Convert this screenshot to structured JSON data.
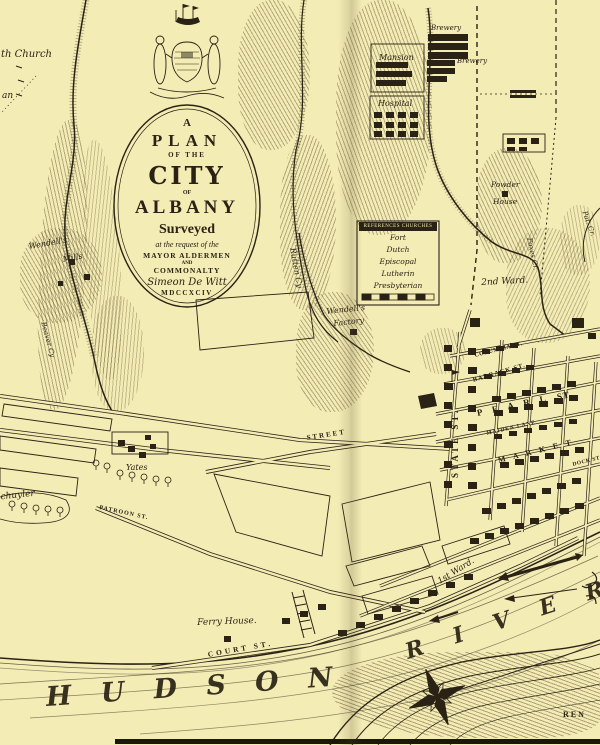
{
  "meta": {
    "title": "A Plan of the City of Albany, 1794"
  },
  "palette": {
    "paper": "#f3ecb5",
    "ink": "#2a2214"
  },
  "cartouche": {
    "lines": [
      {
        "text": "A",
        "cls": "c-a"
      },
      {
        "text": "PLAN",
        "cls": "c-plan"
      },
      {
        "text": "OF THE",
        "cls": "c-ofthe"
      },
      {
        "text": "CITY",
        "cls": "c-city"
      },
      {
        "text": "OF",
        "cls": "c-of"
      },
      {
        "text": "ALBANY",
        "cls": "c-albany"
      },
      {
        "text": "Surveyed",
        "cls": "c-surveyed"
      },
      {
        "text": "at the request of the",
        "cls": "c-req"
      },
      {
        "text": "MAYOR ALDERMEN",
        "cls": "c-mayor"
      },
      {
        "text": "AND",
        "cls": "c-and"
      },
      {
        "text": "COMMONALTY",
        "cls": "c-common"
      },
      {
        "text": "Simeon De Witt",
        "cls": "c-dewitt"
      },
      {
        "text": "MDCCXCIV",
        "cls": "c-date"
      }
    ]
  },
  "legend": {
    "header": "REFERENCES  CHURCHES",
    "items": [
      "Fort",
      "Dutch",
      "Episcopal",
      "Lutherin",
      "Presbyterian"
    ]
  },
  "map": {
    "labels": [
      {
        "name": "label-church-partial",
        "text": "th Church",
        "x": 1,
        "y": 49,
        "rot": 0,
        "fs": 10,
        "cls": "it"
      },
      {
        "name": "label-an-partial",
        "text": "an",
        "x": 2,
        "y": 91,
        "rot": 0,
        "fs": 9,
        "cls": "it"
      },
      {
        "name": "label-mansion",
        "text": "Mansion",
        "x": 379,
        "y": 53,
        "rot": 0,
        "fs": 8,
        "cls": "it"
      },
      {
        "name": "label-brewery-1",
        "text": "Brewery",
        "x": 431,
        "y": 24,
        "rot": 0,
        "fs": 7,
        "cls": "it"
      },
      {
        "name": "label-brewery-2",
        "text": "Brewery",
        "x": 457,
        "y": 57,
        "rot": 0,
        "fs": 7,
        "cls": "it"
      },
      {
        "name": "label-hospital",
        "text": "Hospital",
        "x": 378,
        "y": 99,
        "rot": 0,
        "fs": 8,
        "cls": "it"
      },
      {
        "name": "label-powder-house-1",
        "text": "Powder",
        "x": 491,
        "y": 180,
        "rot": 0,
        "fs": 7.5,
        "cls": "it"
      },
      {
        "name": "label-powder-house-2",
        "text": "House",
        "x": 493,
        "y": 197,
        "rot": 0,
        "fs": 7.5,
        "cls": "it"
      },
      {
        "name": "label-2nd-ward",
        "text": "2nd Ward.",
        "x": 481,
        "y": 278,
        "rot": -3,
        "fs": 9,
        "cls": "it"
      },
      {
        "name": "label-foxes-creek",
        "text": "Foxes Cr.",
        "x": 533,
        "y": 237,
        "rot": 78,
        "fs": 7,
        "cls": "it"
      },
      {
        "name": "label-pat-creek",
        "text": "Pat. Cr.",
        "x": 588,
        "y": 210,
        "rot": 70,
        "fs": 7,
        "cls": "it"
      },
      {
        "name": "label-wendells-mills-1",
        "text": "Wendell's",
        "x": 28,
        "y": 242,
        "rot": -10,
        "fs": 8,
        "cls": "it"
      },
      {
        "name": "label-wendells-mills-2",
        "text": "Mills",
        "x": 62,
        "y": 255,
        "rot": -10,
        "fs": 8,
        "cls": "it"
      },
      {
        "name": "label-rutten-creek",
        "text": "Rutten Cy",
        "x": 297,
        "y": 247,
        "rot": 80,
        "fs": 8,
        "cls": "it"
      },
      {
        "name": "label-wendells-factory-1",
        "text": "Wendell's",
        "x": 326,
        "y": 307,
        "rot": -6,
        "fs": 8,
        "cls": "it"
      },
      {
        "name": "label-wendells-factory-2",
        "text": "Factory",
        "x": 333,
        "y": 319,
        "rot": -6,
        "fs": 8,
        "cls": "it"
      },
      {
        "name": "label-beaver-creek",
        "text": "Beaver Cy",
        "x": 47,
        "y": 321,
        "rot": 75,
        "fs": 7,
        "cls": "it"
      },
      {
        "name": "label-schuyler",
        "text": "Schuyler",
        "x": -6,
        "y": 493,
        "rot": -6,
        "fs": 9,
        "cls": "it"
      },
      {
        "name": "label-yates",
        "text": "Yates",
        "x": 126,
        "y": 463,
        "rot": 0,
        "fs": 8,
        "cls": "it"
      },
      {
        "name": "label-patroon-st",
        "text": "PATROON ST.",
        "x": 100,
        "y": 505,
        "rot": 12,
        "fs": 6,
        "ls": 1,
        "cls": "sc"
      },
      {
        "name": "label-street-partial",
        "text": "STREET",
        "x": 306,
        "y": 434,
        "rot": -9,
        "fs": 7,
        "ls": 2,
        "cls": "sc"
      },
      {
        "name": "label-state-st",
        "text": "STATE ST.",
        "x": 450,
        "y": 478,
        "rot": -90,
        "fs": 9,
        "ls": 3,
        "cls": "sc"
      },
      {
        "name": "label-columbia-st",
        "text": "COLUMBIA ST.",
        "x": 474,
        "y": 353,
        "rot": -14,
        "fs": 6,
        "ls": 0.5,
        "cls": "sc"
      },
      {
        "name": "label-barrack-st",
        "text": "BARRACK ST.",
        "x": 472,
        "y": 377,
        "rot": -16,
        "fs": 6.5,
        "ls": 1,
        "cls": "sc"
      },
      {
        "name": "label-pearl-st",
        "text": "P E A R L",
        "x": 476,
        "y": 408,
        "rot": -12,
        "fs": 9,
        "ls": 4,
        "cls": "sc"
      },
      {
        "name": "label-pearl-st-2",
        "text": "ST.",
        "x": 556,
        "y": 392,
        "rot": -12,
        "fs": 9,
        "ls": 1,
        "cls": "sc"
      },
      {
        "name": "label-maiden-lane",
        "text": "MAIDEN LANE",
        "x": 486,
        "y": 431,
        "rot": -13,
        "fs": 5.5,
        "ls": 1,
        "cls": "sc"
      },
      {
        "name": "label-market-st",
        "text": "M A R K E T",
        "x": 497,
        "y": 456,
        "rot": -14,
        "fs": 8,
        "ls": 3,
        "cls": "sc"
      },
      {
        "name": "label-dock-st",
        "text": "DOCK ST.",
        "x": 572,
        "y": 462,
        "rot": -14,
        "fs": 5.5,
        "ls": 0.5,
        "cls": "sc"
      },
      {
        "name": "label-1st-ward",
        "text": "1st Ward.",
        "x": 436,
        "y": 578,
        "rot": -32,
        "fs": 8.5,
        "cls": "it"
      },
      {
        "name": "label-ferry-house",
        "text": "Ferry House.",
        "x": 197,
        "y": 618,
        "rot": -2,
        "fs": 9,
        "cls": "it"
      },
      {
        "name": "label-court-st",
        "text": "COURT ST.",
        "x": 207,
        "y": 650,
        "rot": -10,
        "fs": 7.5,
        "ls": 3,
        "cls": "sc"
      },
      {
        "name": "label-hudson-river",
        "text": "H U D S O N",
        "x": 45,
        "y": 682,
        "rot": -4,
        "fs": 27,
        "ls": 10,
        "cls": "river"
      },
      {
        "name": "label-river",
        "text": "R I V E R",
        "x": 402,
        "y": 640,
        "rot": -18,
        "fs": 22,
        "ls": 12,
        "cls": "river"
      },
      {
        "name": "label-rensselaer-partial",
        "text": "REN",
        "x": 563,
        "y": 710,
        "rot": 0,
        "fs": 8,
        "ls": 2,
        "cls": "sc"
      }
    ],
    "buildings": [
      [
        444,
        345,
        8,
        7
      ],
      [
        444,
        364,
        8,
        7
      ],
      [
        444,
        383,
        9,
        7
      ],
      [
        444,
        402,
        8,
        7
      ],
      [
        444,
        421,
        8,
        7
      ],
      [
        444,
        441,
        9,
        7
      ],
      [
        444,
        461,
        8,
        7
      ],
      [
        444,
        481,
        8,
        7
      ],
      [
        468,
        348,
        8,
        7
      ],
      [
        468,
        367,
        9,
        7
      ],
      [
        468,
        386,
        8,
        7
      ],
      [
        468,
        405,
        8,
        7
      ],
      [
        468,
        424,
        9,
        7
      ],
      [
        468,
        444,
        8,
        7
      ],
      [
        468,
        463,
        8,
        7
      ],
      [
        468,
        482,
        9,
        7
      ],
      [
        492,
        396,
        9,
        6
      ],
      [
        507,
        393,
        9,
        6
      ],
      [
        522,
        390,
        9,
        6
      ],
      [
        537,
        387,
        9,
        6
      ],
      [
        552,
        384,
        9,
        6
      ],
      [
        567,
        381,
        9,
        6
      ],
      [
        494,
        410,
        9,
        6
      ],
      [
        509,
        407,
        9,
        6
      ],
      [
        524,
        404,
        9,
        6
      ],
      [
        539,
        401,
        9,
        6
      ],
      [
        554,
        398,
        9,
        6
      ],
      [
        569,
        395,
        9,
        6
      ],
      [
        484,
        374,
        8,
        5
      ],
      [
        498,
        371,
        8,
        5
      ],
      [
        512,
        368,
        8,
        5
      ],
      [
        526,
        365,
        8,
        5
      ],
      [
        482,
        349,
        8,
        5
      ],
      [
        496,
        346,
        8,
        5
      ],
      [
        510,
        343,
        8,
        5
      ],
      [
        494,
        434,
        8,
        5
      ],
      [
        509,
        431,
        8,
        5
      ],
      [
        524,
        428,
        8,
        5
      ],
      [
        539,
        425,
        8,
        5
      ],
      [
        554,
        422,
        8,
        5
      ],
      [
        569,
        419,
        8,
        5
      ],
      [
        500,
        462,
        9,
        6
      ],
      [
        515,
        459,
        9,
        6
      ],
      [
        530,
        456,
        9,
        6
      ],
      [
        545,
        453,
        9,
        6
      ],
      [
        560,
        450,
        9,
        6
      ],
      [
        575,
        447,
        9,
        6
      ],
      [
        482,
        508,
        9,
        6
      ],
      [
        497,
        503,
        9,
        6
      ],
      [
        512,
        498,
        9,
        6
      ],
      [
        527,
        493,
        9,
        6
      ],
      [
        542,
        488,
        9,
        6
      ],
      [
        557,
        483,
        9,
        6
      ],
      [
        572,
        478,
        9,
        6
      ],
      [
        470,
        538,
        9,
        6
      ],
      [
        485,
        533,
        9,
        6
      ],
      [
        500,
        528,
        9,
        6
      ],
      [
        515,
        523,
        9,
        6
      ],
      [
        530,
        518,
        9,
        6
      ],
      [
        545,
        513,
        9,
        6
      ],
      [
        560,
        508,
        9,
        6
      ],
      [
        575,
        503,
        9,
        6
      ],
      [
        338,
        630,
        9,
        6
      ],
      [
        356,
        622,
        9,
        6
      ],
      [
        374,
        614,
        9,
        6
      ],
      [
        392,
        606,
        9,
        6
      ],
      [
        410,
        598,
        9,
        6
      ],
      [
        428,
        590,
        9,
        6
      ],
      [
        446,
        582,
        9,
        6
      ],
      [
        464,
        574,
        9,
        6
      ],
      [
        282,
        618,
        8,
        6
      ],
      [
        300,
        611,
        8,
        6
      ],
      [
        318,
        604,
        8,
        6
      ],
      [
        470,
        318,
        10,
        9
      ],
      [
        572,
        318,
        12,
        10
      ],
      [
        588,
        333,
        8,
        6
      ],
      [
        118,
        440,
        7,
        6
      ],
      [
        128,
        446,
        7,
        6
      ],
      [
        139,
        452,
        7,
        6
      ],
      [
        150,
        444,
        6,
        5
      ],
      [
        145,
        435,
        6,
        5
      ],
      [
        224,
        636,
        7,
        6
      ],
      [
        502,
        191,
        6,
        6
      ],
      [
        69,
        259,
        6,
        6
      ],
      [
        84,
        274,
        6,
        6
      ],
      [
        58,
        281,
        5,
        5
      ],
      [
        350,
        329,
        7,
        6
      ],
      [
        376,
        62,
        32,
        6
      ],
      [
        376,
        71,
        36,
        6
      ],
      [
        376,
        80,
        30,
        6
      ],
      [
        374,
        112,
        8,
        6
      ],
      [
        386,
        112,
        8,
        6
      ],
      [
        398,
        112,
        8,
        6
      ],
      [
        410,
        112,
        8,
        6
      ],
      [
        374,
        122,
        8,
        6
      ],
      [
        386,
        122,
        8,
        6
      ],
      [
        398,
        122,
        8,
        6
      ],
      [
        410,
        122,
        8,
        6
      ],
      [
        374,
        131,
        8,
        6
      ],
      [
        386,
        131,
        8,
        6
      ],
      [
        398,
        131,
        8,
        6
      ],
      [
        410,
        131,
        8,
        6
      ],
      [
        428,
        34,
        40,
        7
      ],
      [
        428,
        43,
        40,
        7
      ],
      [
        428,
        52,
        40,
        7
      ],
      [
        427,
        60,
        28,
        6
      ],
      [
        427,
        68,
        28,
        6
      ],
      [
        427,
        76,
        20,
        6
      ],
      [
        510,
        90,
        26,
        3
      ],
      [
        510,
        95,
        26,
        3
      ],
      [
        507,
        138,
        8,
        6
      ],
      [
        519,
        138,
        8,
        6
      ],
      [
        531,
        138,
        8,
        6
      ],
      [
        507,
        147,
        8,
        4
      ],
      [
        519,
        147,
        8,
        4
      ]
    ],
    "trees": [
      [
        12,
        511
      ],
      [
        24,
        513
      ],
      [
        36,
        515
      ],
      [
        48,
        516
      ],
      [
        60,
        517
      ],
      [
        120,
        480
      ],
      [
        132,
        482
      ],
      [
        144,
        484
      ],
      [
        156,
        486
      ],
      [
        168,
        487
      ],
      [
        96,
        470
      ],
      [
        107,
        473
      ]
    ]
  }
}
